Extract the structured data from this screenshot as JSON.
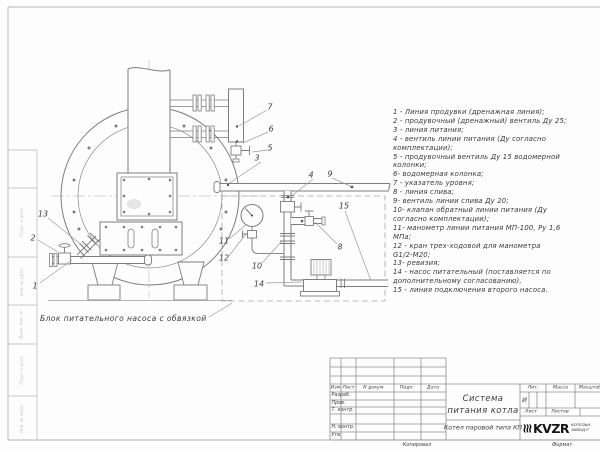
{
  "drawing": {
    "caption": "Блок питательного насоса с обвязкой",
    "callouts": [
      "1",
      "2",
      "3",
      "4",
      "5",
      "6",
      "7",
      "8",
      "9",
      "10",
      "11",
      "12",
      "13",
      "14",
      "15"
    ]
  },
  "legend": {
    "items": [
      "1 - Линия продувки (дренажная линия);",
      "2 - продувочный (дренажный) вентиль Ду 25;",
      "3 - линия питания;",
      "4 - вентиль линии питания (Ду согласно\nкомплектации);",
      "5 - продувочный вентиль Ду 15 водомерной\nколонки;",
      "6- водомерная колонка;",
      "7 - указатель уровня;",
      "8 - линия слива;",
      "9- вентиль линии слива Ду 20;",
      "10- клапан обратный линии питания (Ду\nсогласно комплектации);",
      "11- манометр линии питания МП-100, Ру 1,6\nМПа;",
      "12 - кран трех-ходовой для манометра\nG1/2-М20;",
      "13- ревизия;",
      "14 - насос питательный (поставляется по\nдополнительному согласованию),",
      "15 - линия подключения второго насоса."
    ]
  },
  "titleblock": {
    "header": {
      "izm": "Изм",
      "list": "Лист",
      "doc": "N докум.",
      "podp": "Подп.",
      "data": "Дата"
    },
    "rows": {
      "razrab": "Разраб.",
      "prov": "Пров.",
      "t_kontr": "Т. контр.",
      "n_kontr": "Н. контр.",
      "utv": "Утв."
    },
    "title_line1": "Система",
    "title_line2": "питания котла",
    "product": "Котел паровой типа КП",
    "lit_label": "Лит.",
    "massa_label": "Масса",
    "masshtab_label": "Масштаб",
    "lit_value": "И",
    "list_label": "Лист",
    "listov_label": "Листов",
    "logo_word": "KVZR",
    "logo_sub1": "КОТЕЛЬН",
    "logo_sub2": "ЗАВОД Р",
    "kopiroval": "Копировал",
    "format": "Формат"
  },
  "margin": {
    "labels": [
      "Подп. и дата",
      "Инв. № дубл.",
      "Взам. инв. №",
      "Подп. и дата",
      "Инв. № подл."
    ]
  }
}
